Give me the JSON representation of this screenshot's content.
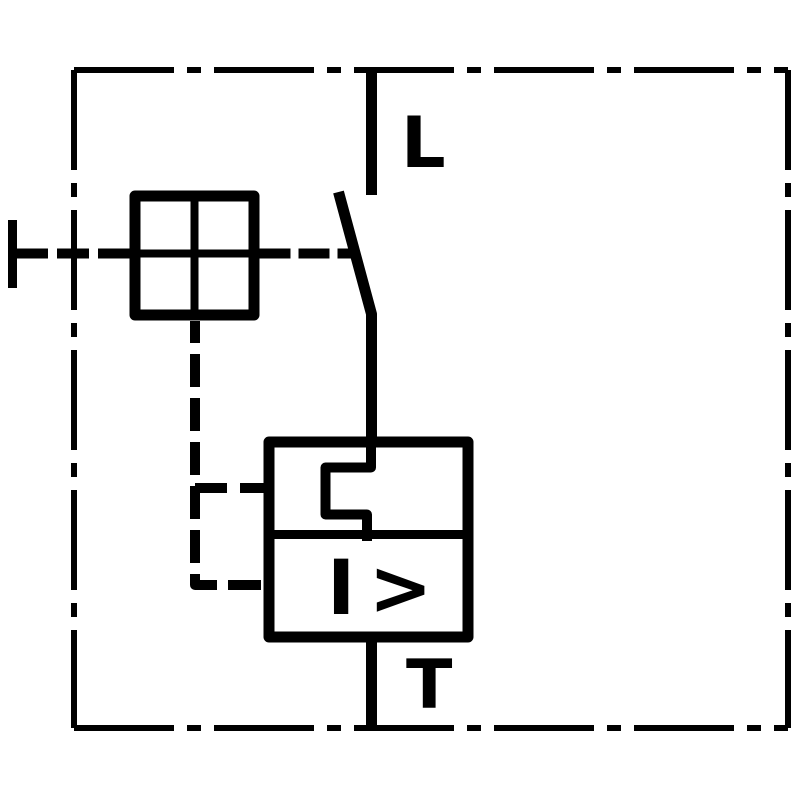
{
  "schematic": {
    "kind": "circuit-breaker-schematic",
    "colors": {
      "stroke": "#000000",
      "background": "#ffffff"
    },
    "terminals": {
      "top_label": "L",
      "bottom_label": "T"
    },
    "relay": {
      "magnetic_release_label": "I >"
    },
    "symbols": [
      {
        "name": "enclosure-boundary",
        "style": "dash-dot"
      },
      {
        "name": "manual-operator-handle",
        "style": "solid-t-bar"
      },
      {
        "name": "actuator-cross-square",
        "style": "square-with-cross"
      },
      {
        "name": "switch-contact-blade",
        "style": "solid"
      },
      {
        "name": "thermal-overload-release",
        "style": "rectangular-detour"
      },
      {
        "name": "magnetic-overcurrent-release",
        "style": "I > in box"
      },
      {
        "name": "mechanical-linkage",
        "style": "dashed"
      }
    ]
  }
}
